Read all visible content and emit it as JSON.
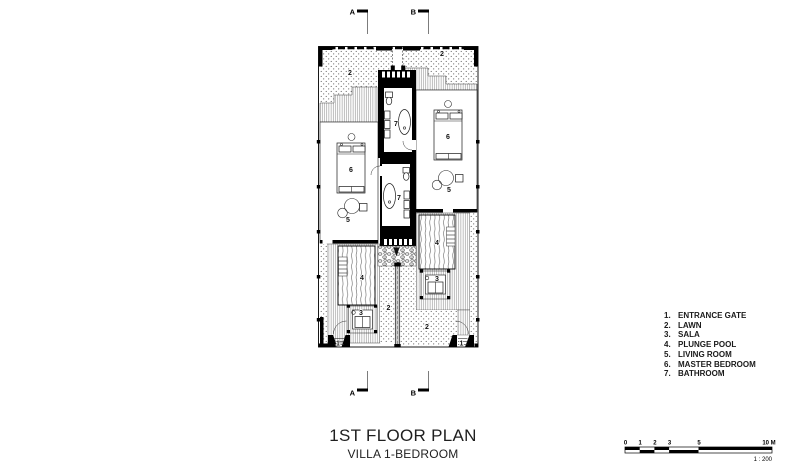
{
  "drawing_title": {
    "main": "1ST FLOOR PLAN",
    "subtitle": "VILLA 1-BEDROOM"
  },
  "section_markers": {
    "a": "A",
    "b": "B"
  },
  "plan": {
    "labels": {
      "lawn_top_left": "2",
      "lawn_top_right": "2",
      "bedroom_left": "6",
      "bedroom_right": "6",
      "living_left": "5",
      "living_right": "5",
      "bathroom_upper": "7",
      "bathroom_lower": "7",
      "pool_left": "4",
      "pool_right": "4",
      "sala_left": "3",
      "sala_right": "3",
      "lawn_bottom_left": "2",
      "lawn_bottom_right": "2",
      "gate_left": "1",
      "gate_right": "1"
    }
  },
  "legend": {
    "items": [
      {
        "num": "1.",
        "label": "ENTRANCE GATE"
      },
      {
        "num": "2.",
        "label": "LAWN"
      },
      {
        "num": "3.",
        "label": "SALA"
      },
      {
        "num": "4.",
        "label": "PLUNGE POOL"
      },
      {
        "num": "5.",
        "label": "LIVING ROOM"
      },
      {
        "num": "6.",
        "label": "MASTER BEDROOM"
      },
      {
        "num": "7.",
        "label": "BATHROOM"
      }
    ]
  },
  "scale_bar": {
    "ticks": [
      "0",
      "1",
      "2",
      "3",
      "5",
      "10 M"
    ],
    "ratio": "1 : 200"
  },
  "colors": {
    "ink": "#000000",
    "paper": "#ffffff",
    "hatch": "#8a8a8a"
  }
}
